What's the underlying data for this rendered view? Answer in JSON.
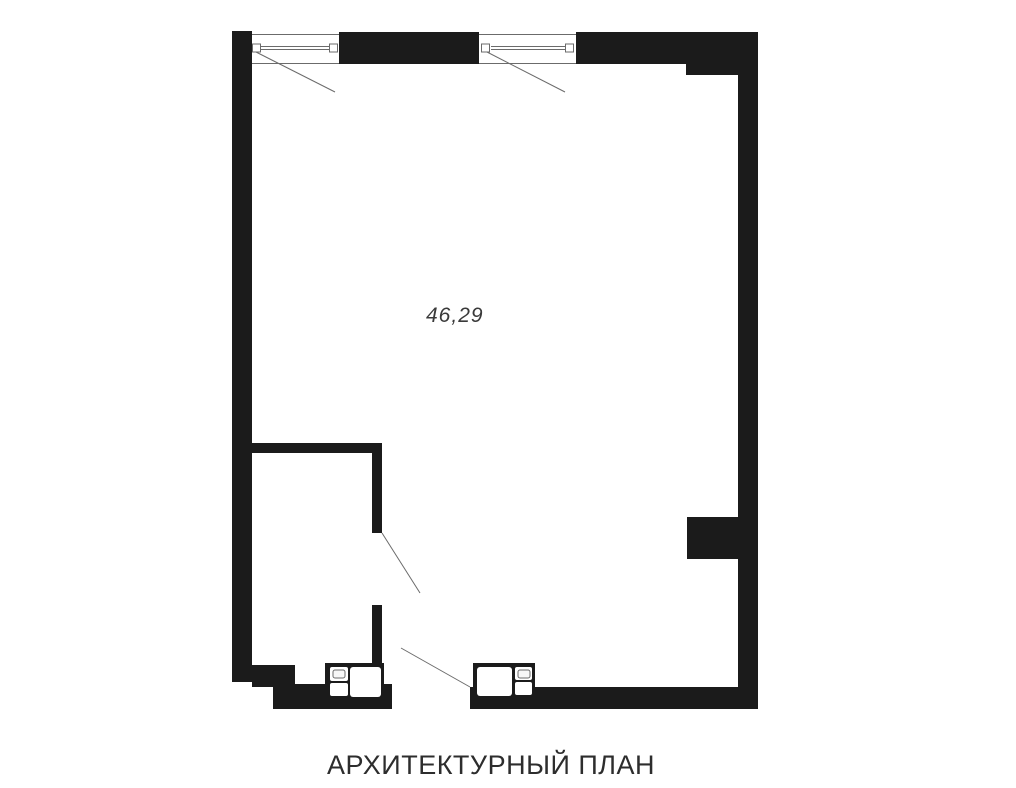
{
  "title": "АРХИТЕКТУРНЫЙ ПЛАН",
  "plan": {
    "area_label": "46,29"
  },
  "colors": {
    "wall": "#1b1b1b",
    "line": "#6b6b6b",
    "title_text": "#2d2d2d",
    "area_text": "#3a3a3a",
    "background": "#ffffff"
  }
}
